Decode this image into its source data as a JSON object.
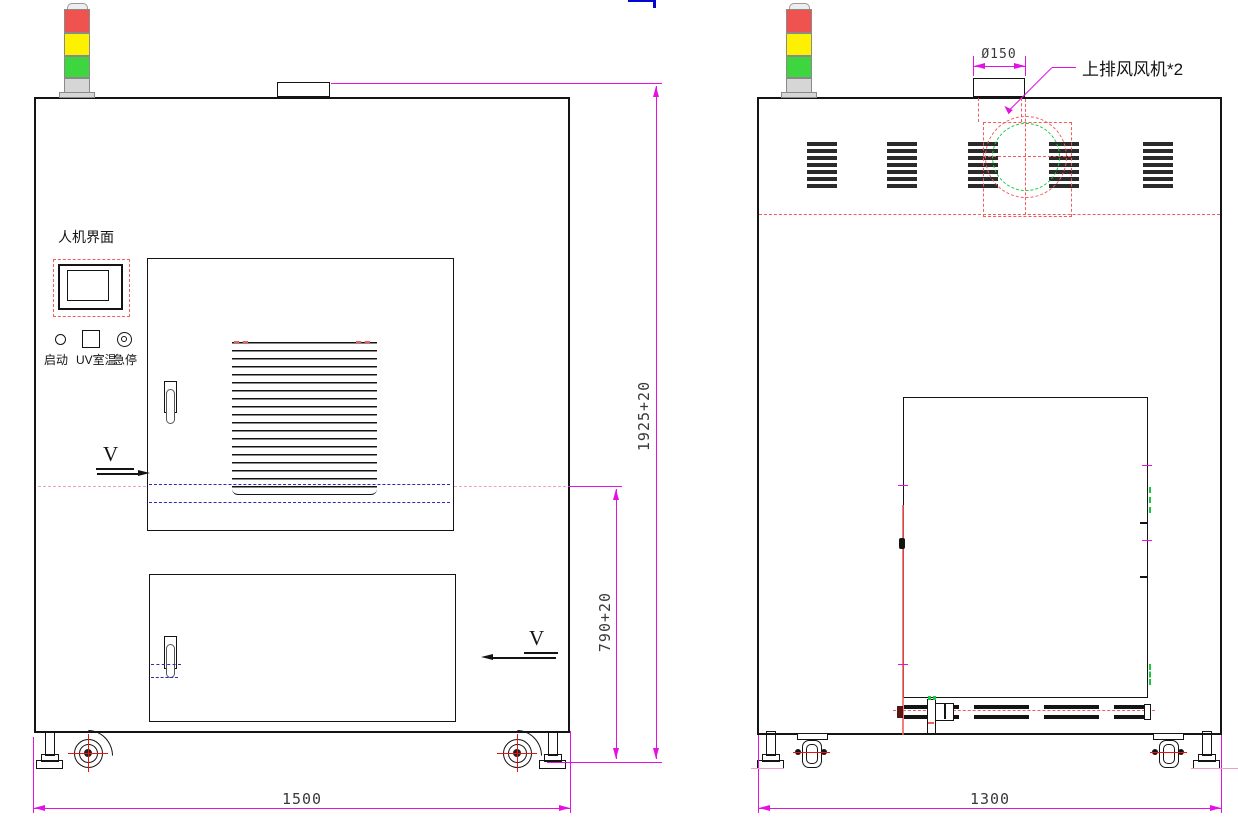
{
  "drawing": {
    "title_views": {
      "front": "front-elevation",
      "side": "side-elevation"
    },
    "front_view": {
      "hmi_label": "人机界面",
      "buttons": [
        {
          "label": "启动",
          "shape": "circle"
        },
        {
          "label": "UV室温",
          "shape": "square"
        },
        {
          "label": "急停",
          "shape": "double-circle"
        }
      ],
      "section_marker_upper": "V",
      "section_marker_lower": "V",
      "width_dim": "1500",
      "total_height_dim": "1925+20",
      "lower_height_dim": "790+20"
    },
    "side_view": {
      "width_dim": "1300",
      "fan_duct_dim": "Ø150",
      "fan_label": "上排风风机*2"
    },
    "tower_light_segments": [
      "red",
      "yellow",
      "green"
    ]
  },
  "colors": {
    "ink": "#141414",
    "dim": "#e312e3",
    "red": "#f25c5c",
    "blue": "#2b2bb8",
    "green": "#16c93e",
    "pink": "#f0a0c8",
    "center_red": "#ee1111",
    "tower_red": "#ef5350",
    "tower_yellow": "#fdf000",
    "tower_green": "#3ed63e",
    "tower_gray": "#d6d6d6"
  }
}
